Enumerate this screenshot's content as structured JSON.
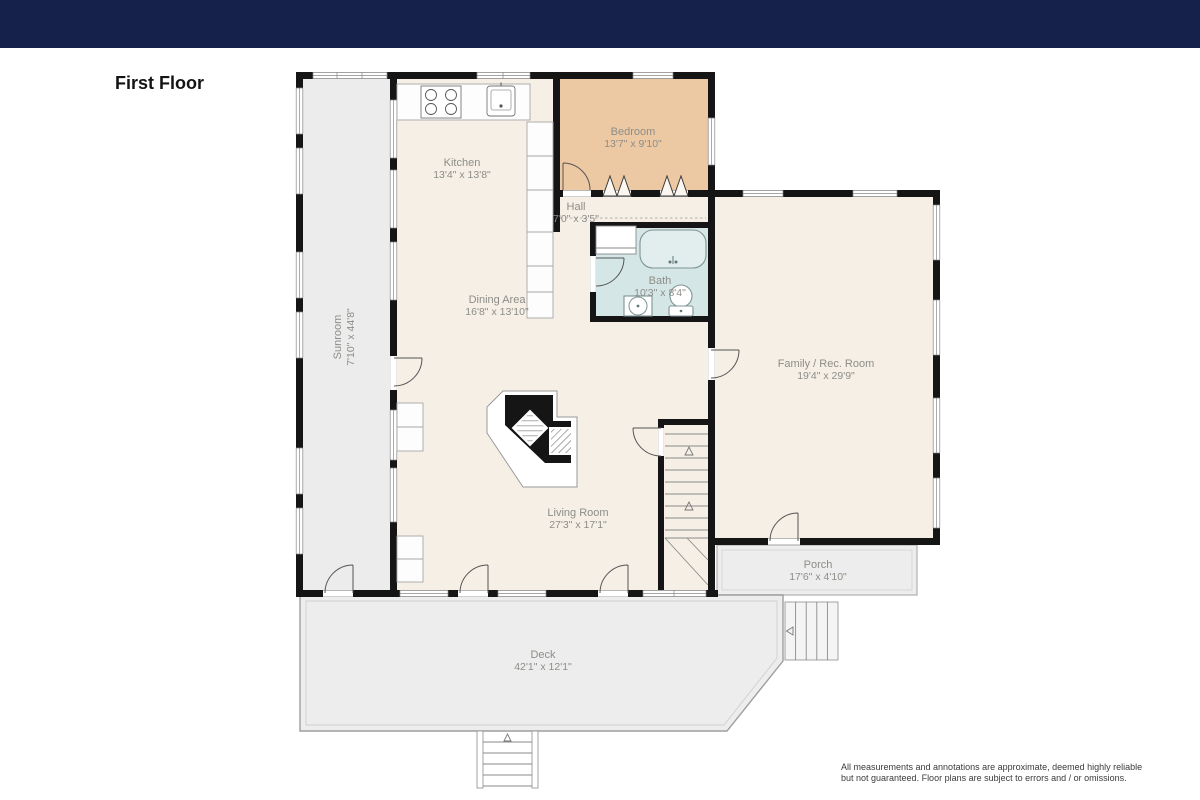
{
  "page": {
    "title": "First Floor"
  },
  "rooms": {
    "sunroom": {
      "label": "Sunroom",
      "dims": "7'10\" x 44'8\""
    },
    "kitchen": {
      "label": "Kitchen",
      "dims": "13'4\" x 13'8\""
    },
    "bedroom": {
      "label": "Bedroom",
      "dims": "13'7\" x 9'10\""
    },
    "hall": {
      "label": "Hall",
      "dims": "7'0\" x 3'5\""
    },
    "bath": {
      "label": "Bath",
      "dims": "10'3\" x 8'4\""
    },
    "dining": {
      "label": "Dining Area",
      "dims": "16'8\" x 13'10\""
    },
    "family": {
      "label": "Family / Rec. Room",
      "dims": "19'4\" x 29'9\""
    },
    "living": {
      "label": "Living Room",
      "dims": "27'3\" x 17'1\""
    },
    "porch": {
      "label": "Porch",
      "dims": "17'6\" x 4'10\""
    },
    "deck": {
      "label": "Deck",
      "dims": "42'1\" x 12'1\""
    }
  },
  "disclaimer": {
    "line1": "All measurements and annotations are approximate, deemed highly reliable",
    "line2": "but not guaranteed. Floor plans are subject to errors and / or omissions."
  },
  "colors": {
    "header": "#16214b",
    "interior": "#f5efe6",
    "bedroom": "#ecc9a3",
    "bath": "#d5e6e6",
    "sunroom": "#ececec",
    "porch": "#ededed",
    "deck": "#ededed",
    "wall": "#151515"
  },
  "fixtures": [
    "stove",
    "kitchen-sink",
    "bathtub",
    "toilet",
    "bathroom-sink",
    "fireplace",
    "interior-staircase",
    "porch-stairs",
    "deck-stairs"
  ]
}
